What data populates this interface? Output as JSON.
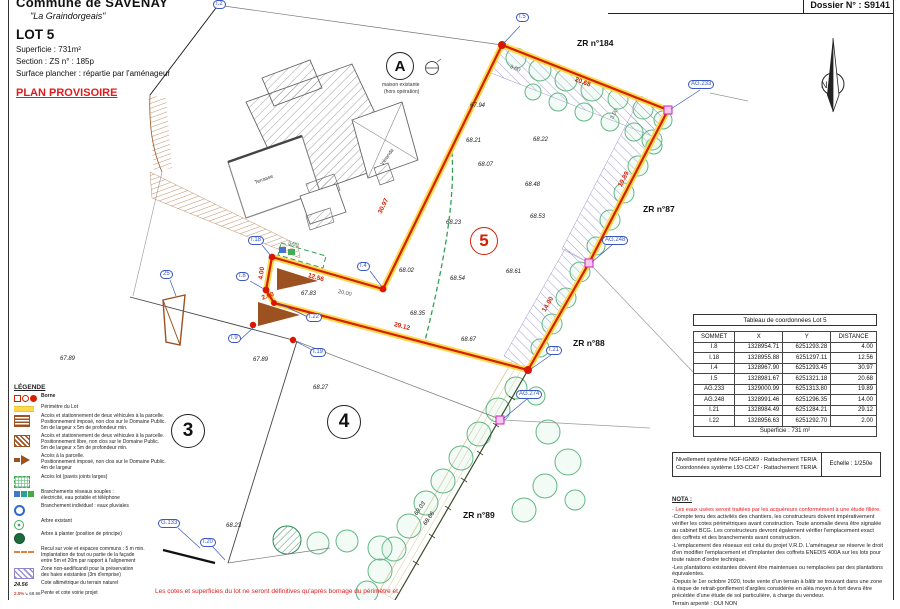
{
  "header": {
    "commune": "Commune de SAVENAY",
    "lieu_dit": "\"La Graindorgeais\"",
    "lot": "LOT 5",
    "superficie": "Superficie : 731m²",
    "section": "Section : ZS      n° : 185p",
    "surface_plancher": "Surface plancher : répartie par l'aménageur",
    "plan_provisoire": "PLAN PROVISOIRE",
    "dossier": "Dossier N° : S9141"
  },
  "compass": {
    "label": "N"
  },
  "colors": {
    "boundary_red": "#d42000",
    "perimeter_yellow": "#ffd94d",
    "label_blue": "#3a57c4",
    "hatch_purple": "#8d86c9",
    "tree_green": "#63b784",
    "access_brown": "#9c5220",
    "provisional_red": "#e01b1b"
  },
  "legend": {
    "title": "LÉGENDE",
    "items": [
      {
        "icon": "borne",
        "bold": true,
        "lines": [
          "Borne"
        ]
      },
      {
        "icon": "perimetre",
        "lines": [
          "Périmètre du Lot"
        ]
      },
      {
        "icon": "acc-imp",
        "lines": [
          "Accès et stationnement de deux véhicules à la parcelle.",
          "Positionnement imposé, non clos sur le Domaine Public.",
          "5m de largeur x 5m de profondeur min."
        ]
      },
      {
        "icon": "acc-lib",
        "lines": [
          "Accès et stationnement de deux véhicules à la parcelle.",
          "Positionnement libre, non clos sur le Domaine Public.",
          "5m de largeur x 5m de profondeur min."
        ]
      },
      {
        "icon": "acc-fleche",
        "lines": [
          "Accès à la parcelle.",
          "Positionnement imposé, non clos sur le Domaine Public.",
          "4m de largeur"
        ]
      },
      {
        "icon": "acc-lot",
        "lines": [
          "Accès lot (pavés joints larges)"
        ]
      },
      {
        "icon": "branchements",
        "lines": [
          "Branchements réseaux souples :",
          "électricité, eau potable et téléphone"
        ]
      },
      {
        "icon": "eaux-pluviales",
        "lines": [
          "Branchement individuel : eaux pluviales"
        ]
      },
      {
        "icon": "arbre-existant",
        "lines": [
          "Arbre existant"
        ]
      },
      {
        "icon": "arbre-planter",
        "lines": [
          "Arbre à planter (position de principe)"
        ]
      },
      {
        "icon": "recul",
        "lines": [
          "Recul sur voie et espaces communs : 5 m min.",
          "Implantation de tout ou partie de la façade",
          "entre 5m et 20m par rapport à l'alignement"
        ]
      },
      {
        "icon": "zone-na",
        "lines": [
          "Zone non-aedificandi pour la préservation",
          "des haies existantes (3m d'emprise)"
        ]
      },
      {
        "icon": "cote-tn",
        "icon_text": "24.56",
        "lines": [
          "Cote altimétrique du terrain naturel"
        ]
      },
      {
        "icon": "pente",
        "icon_text_pct": "2.0%",
        "icon_text_val": "68.96",
        "lines": [
          "Pente et cote voirie projet"
        ]
      }
    ]
  },
  "table": {
    "title": "Tableau de coordonnées Lot 5",
    "headers": [
      "SOMMET",
      "X",
      "Y",
      "DISTANCE"
    ],
    "rows": [
      [
        "I.8",
        "1328954.71",
        "6251293.28",
        "4.00"
      ],
      [
        "I.18",
        "1328955.88",
        "6251297.11",
        "12.56"
      ],
      [
        "I.4",
        "1328967.90",
        "6251293.45",
        "30.97"
      ],
      [
        "I.5",
        "1328981.67",
        "6251321.18",
        "20.68"
      ],
      [
        "AG.233",
        "1329000.99",
        "6251313.80",
        "19.89"
      ],
      [
        "AG.248",
        "1328991.46",
        "6251296.35",
        "14.00"
      ],
      [
        "I.21",
        "1328984.49",
        "6251284.21",
        "29.12"
      ],
      [
        "I.22",
        "1328956.63",
        "6251292.70",
        "2.00"
      ]
    ],
    "footer": "Superficie : 731 m²"
  },
  "info_box": {
    "line1": "Nivellement système NGF-IGN69 - Rattachement TERIA",
    "line2": "Coordonnées système L93-CC47 - Rattachement TERIA",
    "scale": "Echelle : 1/250e"
  },
  "nota": {
    "title": "NOTA :",
    "paragraphs": [
      {
        "color": "red",
        "text": "- Les eaux usées seront traitées par les acquéreurs conformément à une étude filière."
      },
      {
        "text": "-Compte tenu des activités des chantiers, les constructeurs doivent impérativement vérifier les cotes périmétriques avant construction. Toute anomalie devra être signalée au cabinet BCG. Les constructeurs devront également vérifier l'emplacement exact des coffrets et des branchements avant construction."
      },
      {
        "text": "-L'emplacement des réseaux est celui du projet V.R.D. L'aménageur se réserve le droit d'en modifier l'emplacement et d'implanter des coffrets ENEDIS 400A sur les lots pour toute raison d'ordre technique."
      },
      {
        "text": "-Les plantations existantes doivent être maintenues ou remplacées par des plantations équivalentes."
      },
      {
        "text": "-Depuis le 1er octobre 2020, toute vente d'un terrain à bâtir se trouvant dans une zone à risque de retrait-gonflement d'argiles considérée en aléa moyen à fort devra être précédée d'une étude de sol particulière, à charge du vendeur."
      },
      {
        "text": "Terrain arpenté :        OUI        NON"
      }
    ]
  },
  "footnote": "Les cotes et superficies du lot ne seront définitives qu'après bornage du périmètre et",
  "plan": {
    "elevations": [
      {
        "t": "67.94",
        "x": 470,
        "y": 103
      },
      {
        "t": "68.21",
        "x": 466,
        "y": 138
      },
      {
        "t": "68.22",
        "x": 533,
        "y": 137
      },
      {
        "t": "68.07",
        "x": 478,
        "y": 162
      },
      {
        "t": "68.48",
        "x": 525,
        "y": 182
      },
      {
        "t": "68.53",
        "x": 530,
        "y": 214
      },
      {
        "t": "68.23",
        "x": 446,
        "y": 220
      },
      {
        "t": "68.02",
        "x": 399,
        "y": 268
      },
      {
        "t": "68.54",
        "x": 450,
        "y": 276
      },
      {
        "t": "68.61",
        "x": 506,
        "y": 269
      },
      {
        "t": "68.35",
        "x": 410,
        "y": 311
      },
      {
        "t": "68.67",
        "x": 461,
        "y": 337
      },
      {
        "t": "67.83",
        "x": 301,
        "y": 291
      },
      {
        "t": "67.89",
        "x": 253,
        "y": 357
      },
      {
        "t": "67.89",
        "x": 60,
        "y": 356
      },
      {
        "t": "68.27",
        "x": 313,
        "y": 385
      },
      {
        "t": "68.23",
        "x": 226,
        "y": 523
      },
      {
        "t": "69.03",
        "x": 416,
        "y": 512,
        "r": -55
      },
      {
        "t": "68.66",
        "x": 425,
        "y": 522,
        "r": -55
      }
    ],
    "distances_red": [
      {
        "t": "12.56",
        "x": 308,
        "y": 272,
        "r": 16
      },
      {
        "t": "4.00",
        "x": 261,
        "y": 276,
        "r": -82
      },
      {
        "t": "2.00",
        "x": 262,
        "y": 295,
        "r": -20
      },
      {
        "t": "30.97",
        "x": 380,
        "y": 210,
        "r": -64
      },
      {
        "t": "20.68",
        "x": 575,
        "y": 76,
        "r": 21
      },
      {
        "t": "19.89",
        "x": 620,
        "y": 183,
        "r": -62
      },
      {
        "t": "14.00",
        "x": 544,
        "y": 308,
        "r": -60
      },
      {
        "t": "29.12",
        "x": 394,
        "y": 321,
        "r": 15
      }
    ],
    "dims_gray": [
      {
        "t": "20.00",
        "x": 338,
        "y": 289,
        "r": 12
      },
      {
        "t": "3.00",
        "x": 510,
        "y": 64,
        "r": 21
      },
      {
        "t": "3.00",
        "x": 612,
        "y": 116,
        "r": -62
      }
    ],
    "dims_green": [
      {
        "t": "5.00",
        "x": 288,
        "y": 240,
        "r": 15
      }
    ],
    "vertex_labels": [
      {
        "t": "I.2",
        "x": 213,
        "y": 0
      },
      {
        "t": "I.5",
        "x": 516,
        "y": 13
      },
      {
        "t": "AG.233",
        "x": 688,
        "y": 80
      },
      {
        "t": "AG.248",
        "x": 602,
        "y": 236
      },
      {
        "t": "I.21",
        "x": 546,
        "y": 346
      },
      {
        "t": "AG.274",
        "x": 516,
        "y": 390
      },
      {
        "t": "I.18",
        "x": 248,
        "y": 236
      },
      {
        "t": "I.4",
        "x": 357,
        "y": 262
      },
      {
        "t": "I.8",
        "x": 236,
        "y": 272
      },
      {
        "t": "I.22",
        "x": 306,
        "y": 313
      },
      {
        "t": "I.9",
        "x": 228,
        "y": 334
      },
      {
        "t": "I.19",
        "x": 310,
        "y": 348
      },
      {
        "t": "25",
        "x": 160,
        "y": 270
      },
      {
        "t": "G.133",
        "x": 158,
        "y": 519
      },
      {
        "t": "I.20",
        "x": 200,
        "y": 538
      }
    ],
    "parcel_refs": [
      {
        "t": "ZR n°184",
        "x": 577,
        "y": 38
      },
      {
        "t": "ZR n°87",
        "x": 643,
        "y": 204
      },
      {
        "t": "ZR n°88",
        "x": 573,
        "y": 338
      },
      {
        "t": "ZR n°89",
        "x": 463,
        "y": 510
      }
    ],
    "lot_circles": [
      {
        "t": "A",
        "x": 399,
        "y": 65,
        "r": 13,
        "red": false,
        "fs": 15
      },
      {
        "t": "3",
        "x": 187,
        "y": 430,
        "r": 16,
        "red": false,
        "fs": 19
      },
      {
        "t": "4",
        "x": 343,
        "y": 421,
        "r": 16,
        "red": false,
        "fs": 19
      },
      {
        "t": "5",
        "x": 483,
        "y": 240,
        "r": 13,
        "red": true,
        "fs": 17
      }
    ],
    "notes": [
      {
        "t": "maison existante",
        "x": 382,
        "y": 82
      },
      {
        "t": "(hors opération)",
        "x": 384,
        "y": 89
      },
      {
        "t": "Terrasse",
        "x": 255,
        "y": 180,
        "r": -20
      },
      {
        "t": "Véranda",
        "x": 382,
        "y": 162,
        "r": -55
      }
    ]
  }
}
